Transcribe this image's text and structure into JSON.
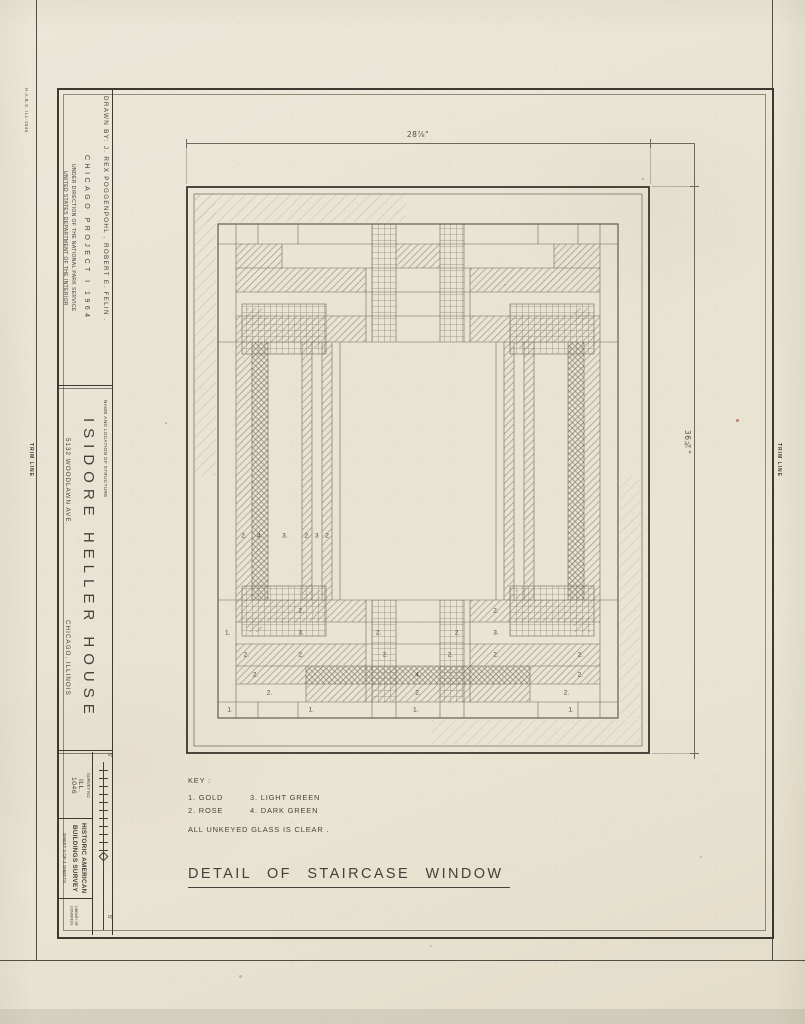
{
  "edge": {
    "trim_line_left": "TRIM LINE",
    "trim_line_right": "TRIM LINE",
    "corner_mark": "H.A.B.S. ILL-1046"
  },
  "title_block": {
    "direction_line1": "UNDER DIRECTION OF THE NATIONAL PARK SERVICE",
    "direction_line2": "UNITED STATES DEPARTMENT OF THE INTERIOR",
    "project": "CHICAGO PROJECT I 1964",
    "drawn_by": "DRAWN BY: J. REX POGGENPOHL , ROBERT E. FELIN .",
    "structure_label": "NAME AND LOCATION OF STRUCTURE",
    "structure_name": "ISIDORE HELLER HOUSE",
    "structure_address": "5132 WOODLAWN AVE.",
    "structure_city": "CHICAGO, ILLINOIS",
    "survey_label": "SURVEY NO.",
    "survey_no_line1": "ILL.",
    "survey_no_line2": "1046",
    "agency_line1": "HISTORIC AMERICAN",
    "agency_line2": "BUILDINGS SURVEY",
    "sheet_info": "SHEET 4 OF 4 SHEETS",
    "stamp": "LIBRARY OF CONGRESS"
  },
  "scale_bar": {
    "top_label": "5'",
    "bottom_label": "5'"
  },
  "drawing": {
    "dim_width": "28⅞\"",
    "dim_height": "36¾\"",
    "title": "DETAIL OF STAIRCASE WINDOW",
    "key": {
      "heading": "KEY :",
      "items": [
        "1. GOLD",
        "2. ROSE",
        "3. LIGHT GREEN",
        "4. DARK GREEN"
      ],
      "note": "ALL UNKEYED GLASS IS CLEAR ."
    },
    "glass_labels": [
      {
        "t": "2.",
        "x": 12.5,
        "y": 61.6
      },
      {
        "t": "4.",
        "x": 15.9,
        "y": 61.6
      },
      {
        "t": "3.",
        "x": 21.3,
        "y": 61.6
      },
      {
        "t": "2.",
        "x": 26.1,
        "y": 61.6
      },
      {
        "t": "3",
        "x": 28.2,
        "y": 61.6
      },
      {
        "t": "2",
        "x": 30.4,
        "y": 61.6
      },
      {
        "t": "2.",
        "x": 24.8,
        "y": 74.8
      },
      {
        "t": "2.",
        "x": 66.8,
        "y": 74.8
      },
      {
        "t": "1.",
        "x": 9.0,
        "y": 78.7
      },
      {
        "t": "3.",
        "x": 24.8,
        "y": 78.7
      },
      {
        "t": "2.",
        "x": 41.5,
        "y": 78.7
      },
      {
        "t": "2.",
        "x": 58.5,
        "y": 78.7
      },
      {
        "t": "3.",
        "x": 66.8,
        "y": 78.7
      },
      {
        "t": "2.",
        "x": 13.0,
        "y": 82.6
      },
      {
        "t": "2.",
        "x": 24.8,
        "y": 82.6
      },
      {
        "t": "2.",
        "x": 43.0,
        "y": 82.6
      },
      {
        "t": "2.",
        "x": 57.0,
        "y": 82.6
      },
      {
        "t": "2.",
        "x": 66.8,
        "y": 82.6
      },
      {
        "t": "2.",
        "x": 85.0,
        "y": 82.6
      },
      {
        "t": "2.",
        "x": 15.0,
        "y": 86.1
      },
      {
        "t": "4.",
        "x": 50.0,
        "y": 86.1
      },
      {
        "t": "2.",
        "x": 85.0,
        "y": 86.1
      },
      {
        "t": "2.",
        "x": 18.0,
        "y": 89.3
      },
      {
        "t": "2.",
        "x": 50.0,
        "y": 89.3
      },
      {
        "t": "2.",
        "x": 82.0,
        "y": 89.3
      },
      {
        "t": "1.",
        "x": 9.5,
        "y": 92.3
      },
      {
        "t": "1.",
        "x": 27.0,
        "y": 92.3
      },
      {
        "t": "1.",
        "x": 49.5,
        "y": 92.3
      },
      {
        "t": "1.",
        "x": 83.0,
        "y": 92.3
      }
    ]
  }
}
